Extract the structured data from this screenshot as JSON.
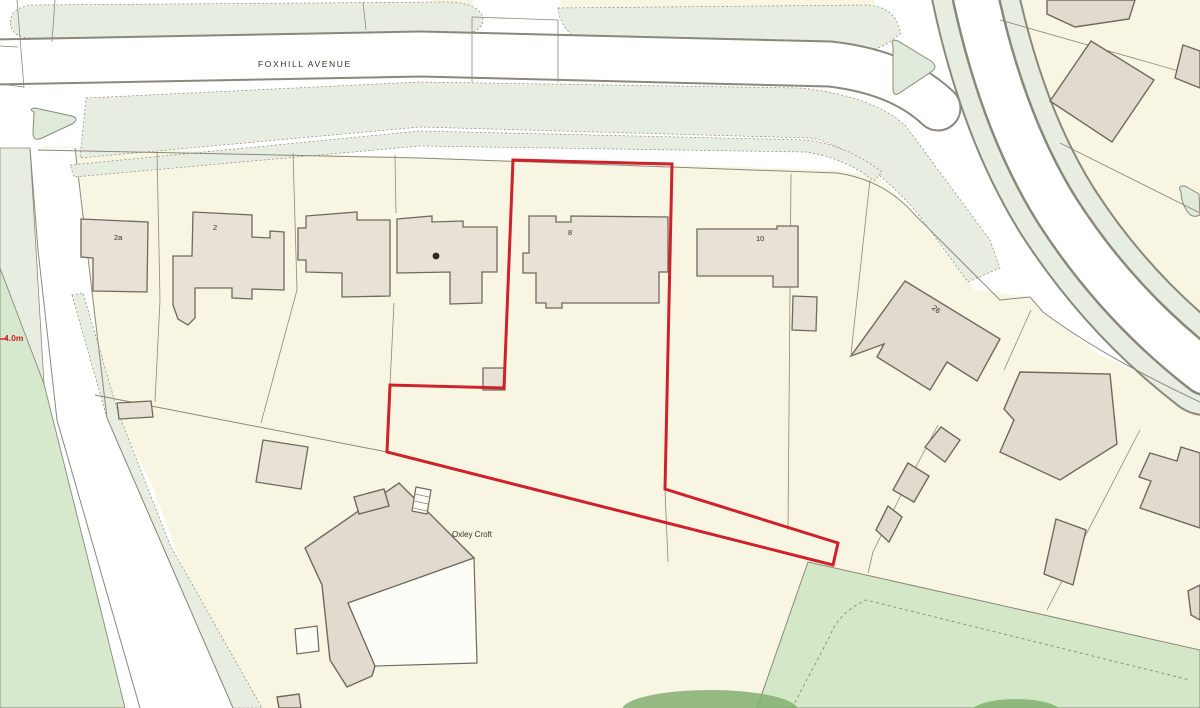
{
  "map": {
    "type": "site-location-plan",
    "labels": {
      "street": "FOXHILL AVENUE",
      "property": "Oxley Croft",
      "dimension": "4.0m"
    },
    "house_numbers": {
      "n2a": "2a",
      "n2": "2",
      "n8": "8",
      "n10": "10",
      "n26": "26"
    },
    "colors": {
      "background": "#ffffff",
      "parcel": "#f8f6e3",
      "building": "#e7e1d6",
      "building_dark": "#e2dacf",
      "building_stroke": "#6f695e",
      "line": "#8a887b",
      "verge": "#e7eee1",
      "field": "#d7e9cd",
      "meadow": "#d4e8c8",
      "tree": "#83af70",
      "island": "#dfeada",
      "boundary_red": "#cf2129",
      "label": "#33322a"
    },
    "red_boundary_points": "513,160 672,164 665,489 838,543 833,565 387,452 390,385 504,388"
  }
}
